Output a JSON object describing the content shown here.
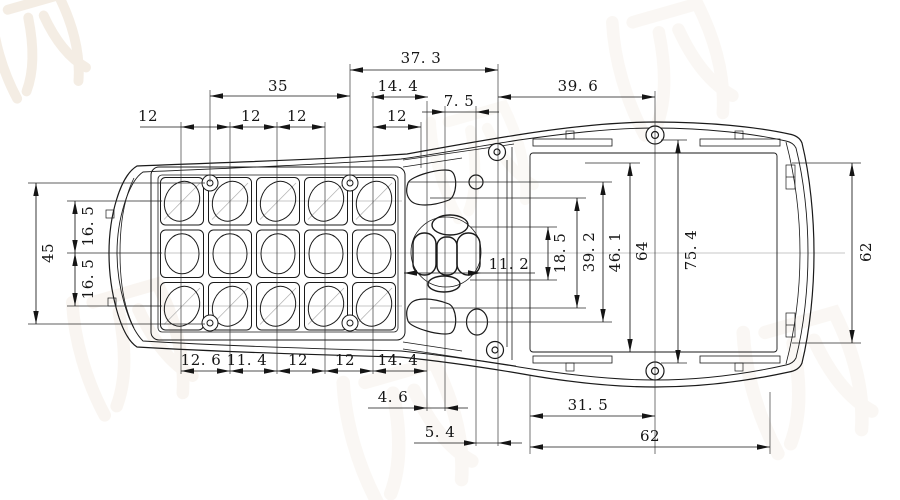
{
  "drawing": {
    "title": "handheld-housing-dimension-drawing",
    "colors": {
      "line": "#1a1a1a",
      "dim": "#151515",
      "ext": "#2a2a2a",
      "centerline": "#b5b5b5",
      "watermark": "#c9a87c",
      "background": "#ffffff"
    },
    "dims_h": [
      {
        "t": "37. 3",
        "x1": 350,
        "x2": 498,
        "y": 70,
        "lx": 421,
        "ly": 58,
        "s": "in"
      },
      {
        "t": "35",
        "x1": 210,
        "x2": 350,
        "y": 96,
        "lx": 278,
        "ly": 86,
        "s": "in"
      },
      {
        "t": "14. 4",
        "x1": 371,
        "x2": 428,
        "y": 97,
        "lx": 398,
        "ly": 86,
        "s": "in"
      },
      {
        "t": "39. 6",
        "x1": 498,
        "x2": 655,
        "y": 97,
        "lx": 578,
        "ly": 86,
        "s": "in"
      },
      {
        "t": "7. 5",
        "x1": 445,
        "x2": 476,
        "y": 112,
        "lx": 459,
        "ly": 101,
        "s": "out",
        "x0": 422,
        "x3": 499
      },
      {
        "t": "12",
        "x1": 181,
        "x2": 230,
        "y": 127,
        "lx": 148,
        "ly": 116,
        "s": "in",
        "x0": 140
      },
      {
        "t": "12",
        "x1": 230,
        "x2": 277,
        "y": 127,
        "lx": 251,
        "ly": 116,
        "s": "in"
      },
      {
        "t": "12",
        "x1": 277,
        "x2": 325,
        "y": 127,
        "lx": 297,
        "ly": 116,
        "s": "in"
      },
      {
        "t": "12",
        "x1": 373,
        "x2": 421,
        "y": 127,
        "lx": 397,
        "ly": 116,
        "s": "in"
      },
      {
        "t": "11. 2",
        "x1": 404,
        "x2": 481,
        "y": 273,
        "lx": 509,
        "ly": 264,
        "s": "in",
        "x3": 535
      },
      {
        "t": "12. 6",
        "x1": 181,
        "x2": 230,
        "y": 371,
        "lx": 201,
        "ly": 360,
        "s": "in"
      },
      {
        "t": "11. 4",
        "x1": 230,
        "x2": 277,
        "y": 371,
        "lx": 247,
        "ly": 360,
        "s": "in"
      },
      {
        "t": "12",
        "x1": 277,
        "x2": 325,
        "y": 371,
        "lx": 298,
        "ly": 360,
        "s": "in"
      },
      {
        "t": "12",
        "x1": 325,
        "x2": 373,
        "y": 371,
        "lx": 345,
        "ly": 360,
        "s": "in"
      },
      {
        "t": "14. 4",
        "x1": 373,
        "x2": 427,
        "y": 371,
        "lx": 398,
        "ly": 360,
        "s": "in"
      },
      {
        "t": "4. 6",
        "x1": 427,
        "x2": 445,
        "y": 408,
        "lx": 393,
        "ly": 397,
        "s": "out",
        "x0": 368,
        "x3": 468
      },
      {
        "t": "5. 4",
        "x1": 477,
        "x2": 498,
        "y": 443,
        "lx": 440,
        "ly": 432,
        "s": "out",
        "x0": 414,
        "x3": 522
      },
      {
        "t": "31. 5",
        "x1": 530,
        "x2": 655,
        "y": 416,
        "lx": 588,
        "ly": 405,
        "s": "in"
      },
      {
        "t": "62",
        "x1": 530,
        "x2": 770,
        "y": 447,
        "lx": 650,
        "ly": 436,
        "s": "in"
      }
    ],
    "dims_v": [
      {
        "t": "45",
        "x": 36,
        "y1": 183,
        "y2": 324,
        "lx": 48,
        "ly": 253
      },
      {
        "t": "16. 5",
        "x": 75,
        "y1": 201,
        "y2": 253,
        "lx": 88,
        "ly": 226
      },
      {
        "t": "16. 5",
        "x": 75,
        "y1": 253,
        "y2": 306,
        "lx": 88,
        "ly": 279
      },
      {
        "t": "18. 5",
        "x": 548,
        "y1": 227,
        "y2": 280,
        "lx": 560,
        "ly": 253
      },
      {
        "t": "39. 2",
        "x": 577,
        "y1": 198,
        "y2": 308,
        "lx": 589,
        "ly": 252
      },
      {
        "t": "46. 1",
        "x": 603,
        "y1": 182,
        "y2": 322,
        "lx": 615,
        "ly": 252
      },
      {
        "t": "64",
        "x": 630,
        "y1": 163,
        "y2": 352,
        "lx": 642,
        "ly": 251
      },
      {
        "t": "75. 4",
        "x": 678,
        "y1": 140,
        "y2": 363,
        "lx": 691,
        "ly": 250
      },
      {
        "t": "62",
        "x": 852,
        "y1": 163,
        "y2": 343,
        "lx": 866,
        "ly": 252
      }
    ],
    "ext_v": [
      [
        181,
        122,
        374
      ],
      [
        230,
        122,
        374
      ],
      [
        277,
        122,
        374
      ],
      [
        325,
        122,
        374
      ],
      [
        373,
        92,
        374
      ],
      [
        421,
        122,
        168
      ],
      [
        427,
        101,
        411
      ],
      [
        445,
        106,
        411
      ],
      [
        476,
        106,
        446
      ],
      [
        498,
        64,
        446
      ],
      [
        655,
        91,
        454
      ],
      [
        530,
        376,
        454
      ],
      [
        770,
        392,
        454
      ],
      [
        210,
        90,
        182
      ],
      [
        350,
        64,
        182
      ]
    ],
    "ext_h": [
      [
        183,
        28,
        205
      ],
      [
        324,
        28,
        205
      ],
      [
        201,
        67,
        162
      ],
      [
        253,
        67,
        162
      ],
      [
        306,
        67,
        162
      ],
      [
        227,
        470,
        557
      ],
      [
        280,
        470,
        557
      ],
      [
        198,
        430,
        586
      ],
      [
        308,
        430,
        586
      ],
      [
        182,
        408,
        612
      ],
      [
        322,
        408,
        612
      ],
      [
        163,
        585,
        640
      ],
      [
        140,
        661,
        687
      ],
      [
        363,
        661,
        687
      ],
      [
        163,
        792,
        861
      ],
      [
        343,
        792,
        861
      ]
    ],
    "centerlines": [
      [
        201,
        140,
        402
      ],
      [
        306,
        140,
        402
      ],
      [
        253,
        162,
        845
      ]
    ],
    "keypad": {
      "cols": [
        158,
        206,
        254,
        302,
        350
      ],
      "rows": [
        175,
        227.5,
        280
      ],
      "cell_w": 48,
      "cell_h": 52.5,
      "hole_rx": 17,
      "hole_ry": 20.5,
      "tilt_deg": 25,
      "screws": [
        [
          210,
          183
        ],
        [
          350,
          183
        ],
        [
          210,
          323
        ],
        [
          350,
          323
        ]
      ]
    },
    "watermark": {
      "instances": [
        {
          "x": -18,
          "y": 8,
          "sc": 1.1,
          "rot": -16,
          "op": 0.2
        },
        {
          "x": 60,
          "y": 300,
          "sc": 1.4,
          "rot": -16,
          "op": 0.1
        },
        {
          "x": 330,
          "y": 380,
          "sc": 1.5,
          "rot": -16,
          "op": 0.08
        },
        {
          "x": 600,
          "y": 20,
          "sc": 1.4,
          "rot": -16,
          "op": 0.08
        },
        {
          "x": 730,
          "y": 330,
          "sc": 1.5,
          "rot": -16,
          "op": 0.08
        },
        {
          "x": 420,
          "y": 120,
          "sc": 1.2,
          "rot": -16,
          "op": 0.06
        }
      ]
    }
  }
}
